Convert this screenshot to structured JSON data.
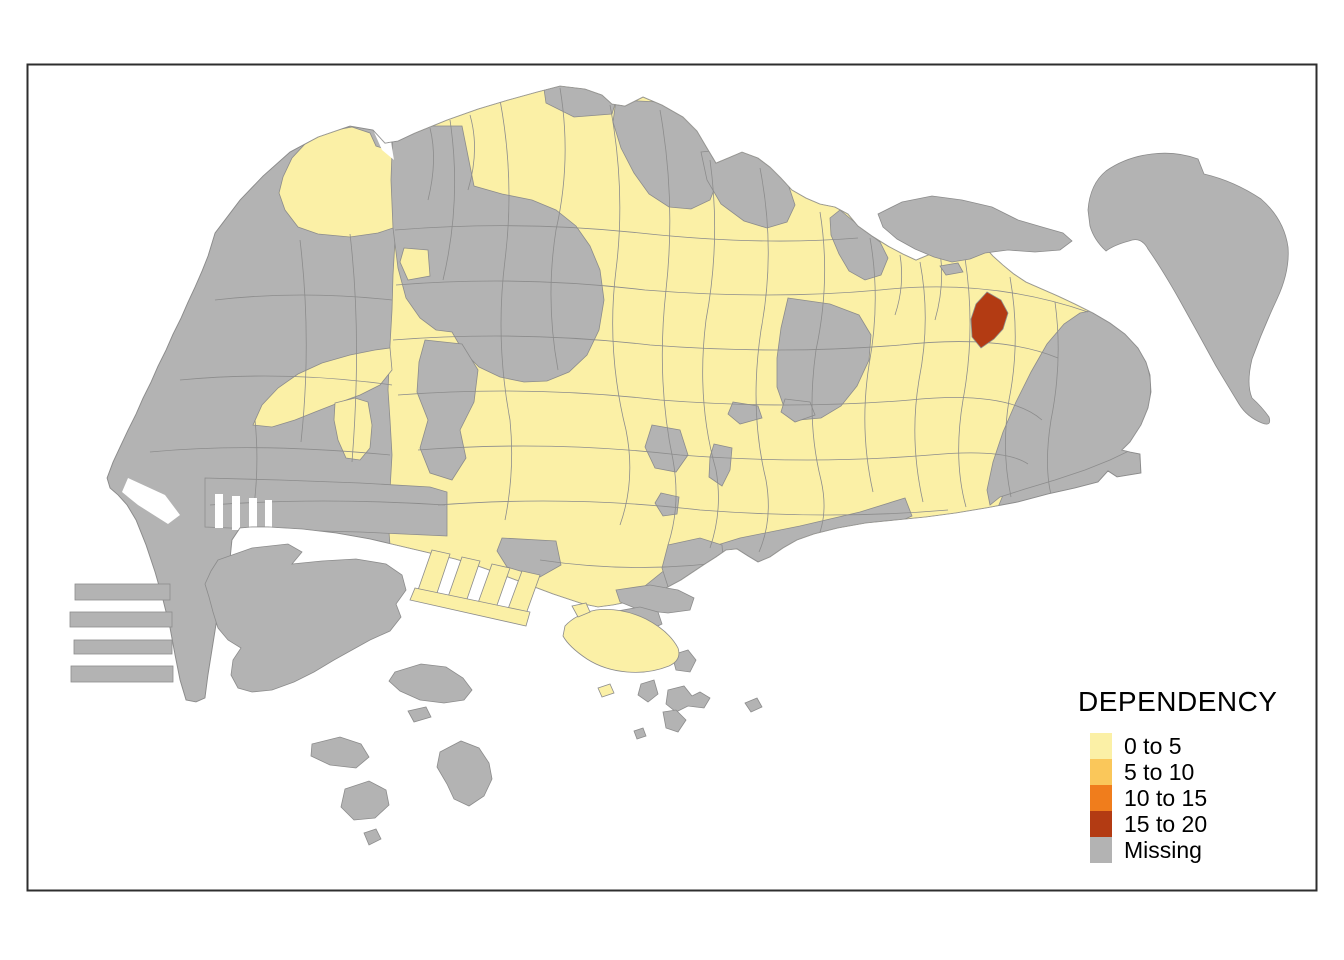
{
  "figure": {
    "legend": {
      "title": "DEPENDENCY",
      "items": [
        {
          "label": "0 to 5",
          "color": "#FBF0A6"
        },
        {
          "label": "5 to 10",
          "color": "#FAC75A"
        },
        {
          "label": "10 to 15",
          "color": "#F07D1C"
        },
        {
          "label": "15 to 20",
          "color": "#B33B13"
        },
        {
          "label": "Missing",
          "color": "#B3B3B3"
        }
      ]
    },
    "palette": {
      "sea": "#FFFFFF",
      "frame_border": "#2E2E2E",
      "region_border": "#8C8C8C",
      "class_0_5": "#FBF0A6",
      "class_5_10": "#FAC75A",
      "class_10_15": "#F07D1C",
      "class_15_20": "#B33B13",
      "missing": "#B3B3B3"
    }
  }
}
